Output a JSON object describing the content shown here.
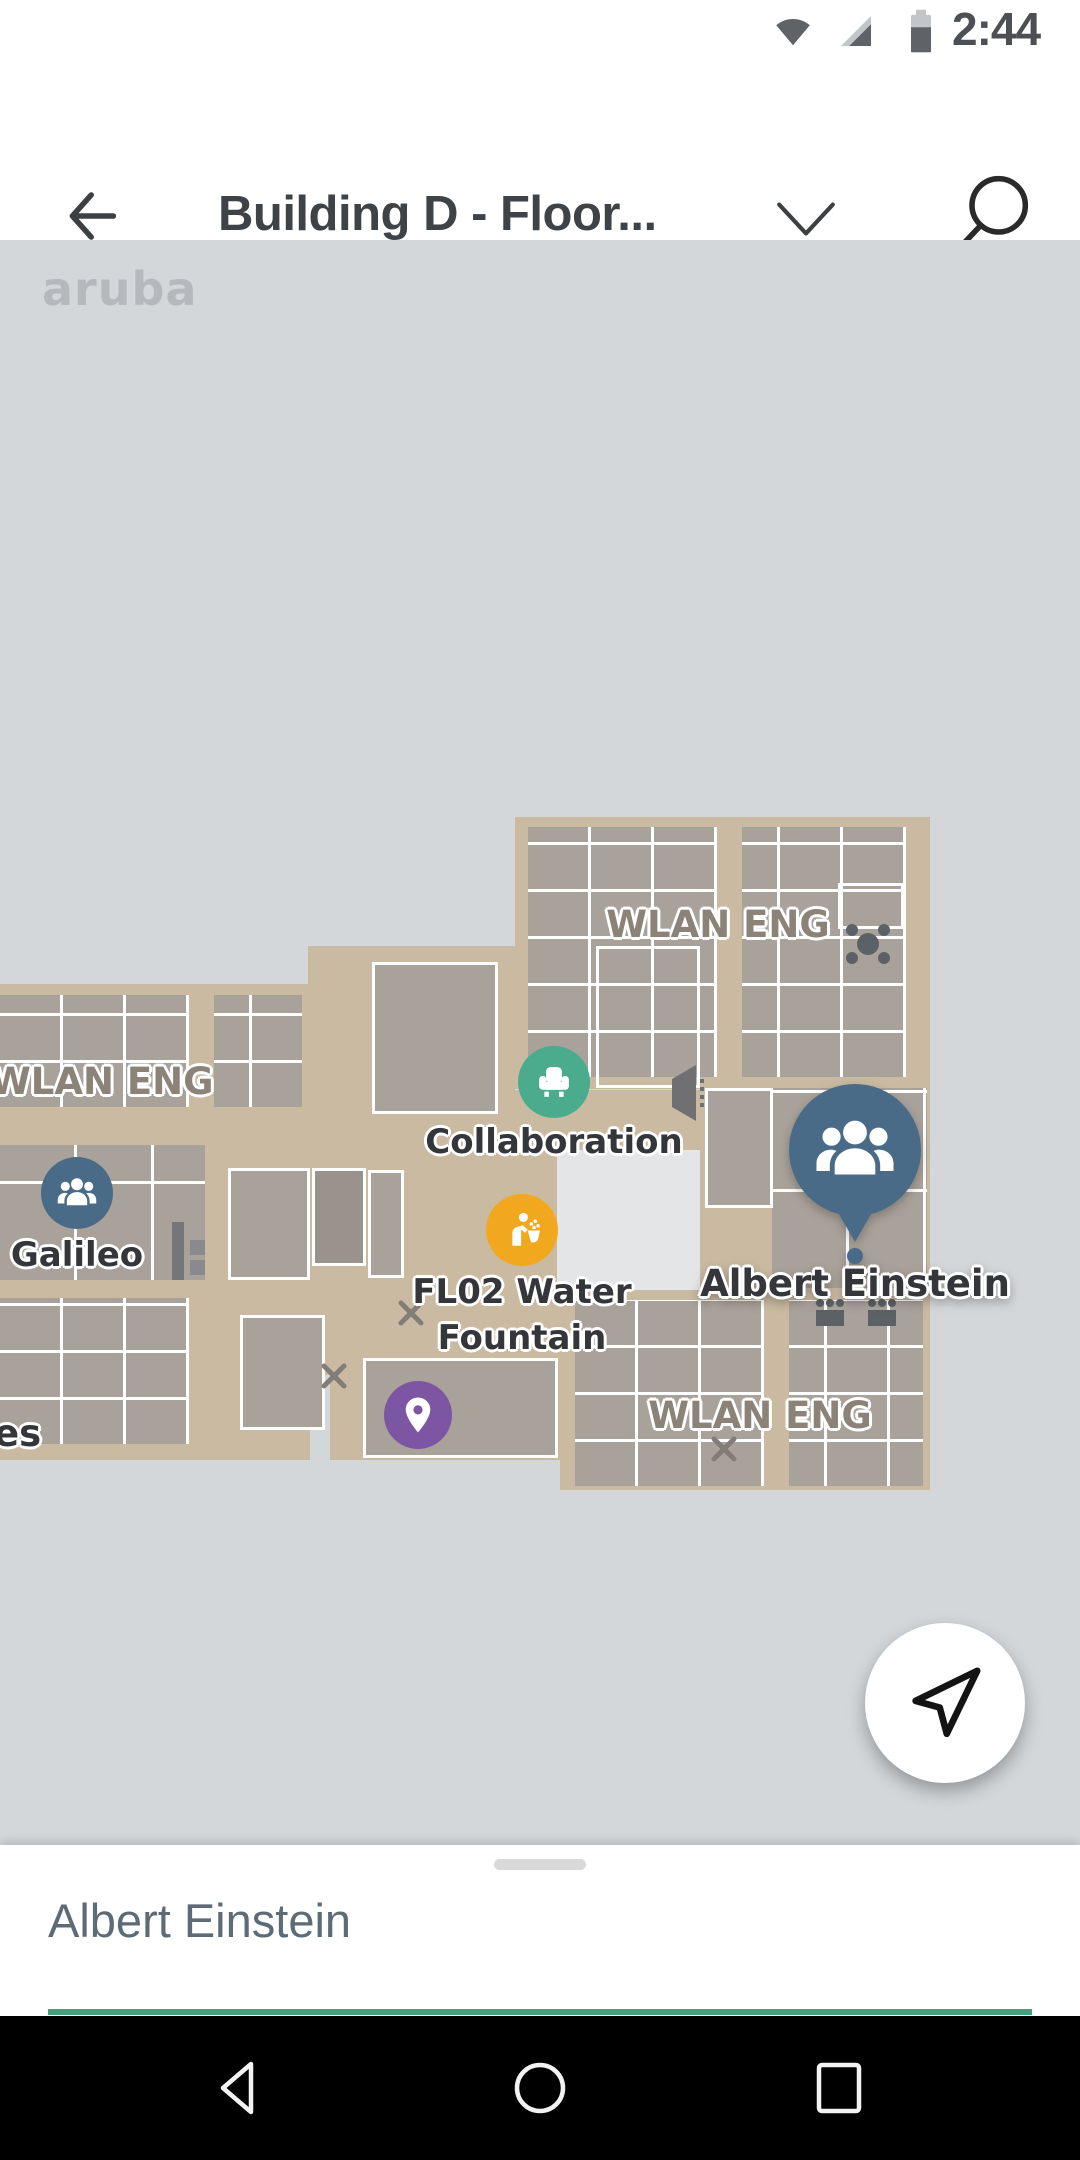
{
  "status_bar": {
    "time": "2:44",
    "icons": [
      "wifi-icon",
      "cell-signal-icon",
      "battery-icon"
    ]
  },
  "app_bar": {
    "title": "Building D - Floor...",
    "back_icon": "back-arrow-icon",
    "dropdown_icon": "chevron-down-icon",
    "search_icon": "search-icon"
  },
  "map": {
    "watermark": "aruba",
    "room_labels": [
      {
        "text": "WLAN ENG"
      },
      {
        "text": "WLAN ENG"
      },
      {
        "text": "WLAN ENG"
      },
      {
        "text": "es"
      }
    ],
    "markers": [
      {
        "name": "Collaboration",
        "label": "Collaboration",
        "color": "#4aab8d",
        "icon": "armchair-icon"
      },
      {
        "name": "Galileo",
        "label": "Galileo",
        "color": "#4a6b88",
        "icon": "people-icon"
      },
      {
        "name": "FL02 Water Fountain",
        "label_line1": "FL02 Water",
        "label_line2": "Fountain",
        "color": "#f1a81f",
        "icon": "drinking-fountain-icon"
      },
      {
        "name": "Dropped pin",
        "color": "#7d56a3",
        "icon": "map-pin-icon"
      },
      {
        "name": "Albert Einstein",
        "label": "Albert Einstein",
        "color": "#4a6b88",
        "icon": "people-icon",
        "selected": true
      }
    ]
  },
  "fab": {
    "icon": "navigate-arrow-icon"
  },
  "bottom_sheet": {
    "title": "Albert Einstein",
    "accent_color": "#44a17c"
  },
  "navigation_bar": {
    "icons": [
      "back-triangle-icon",
      "home-circle-icon",
      "recents-square-icon"
    ]
  }
}
